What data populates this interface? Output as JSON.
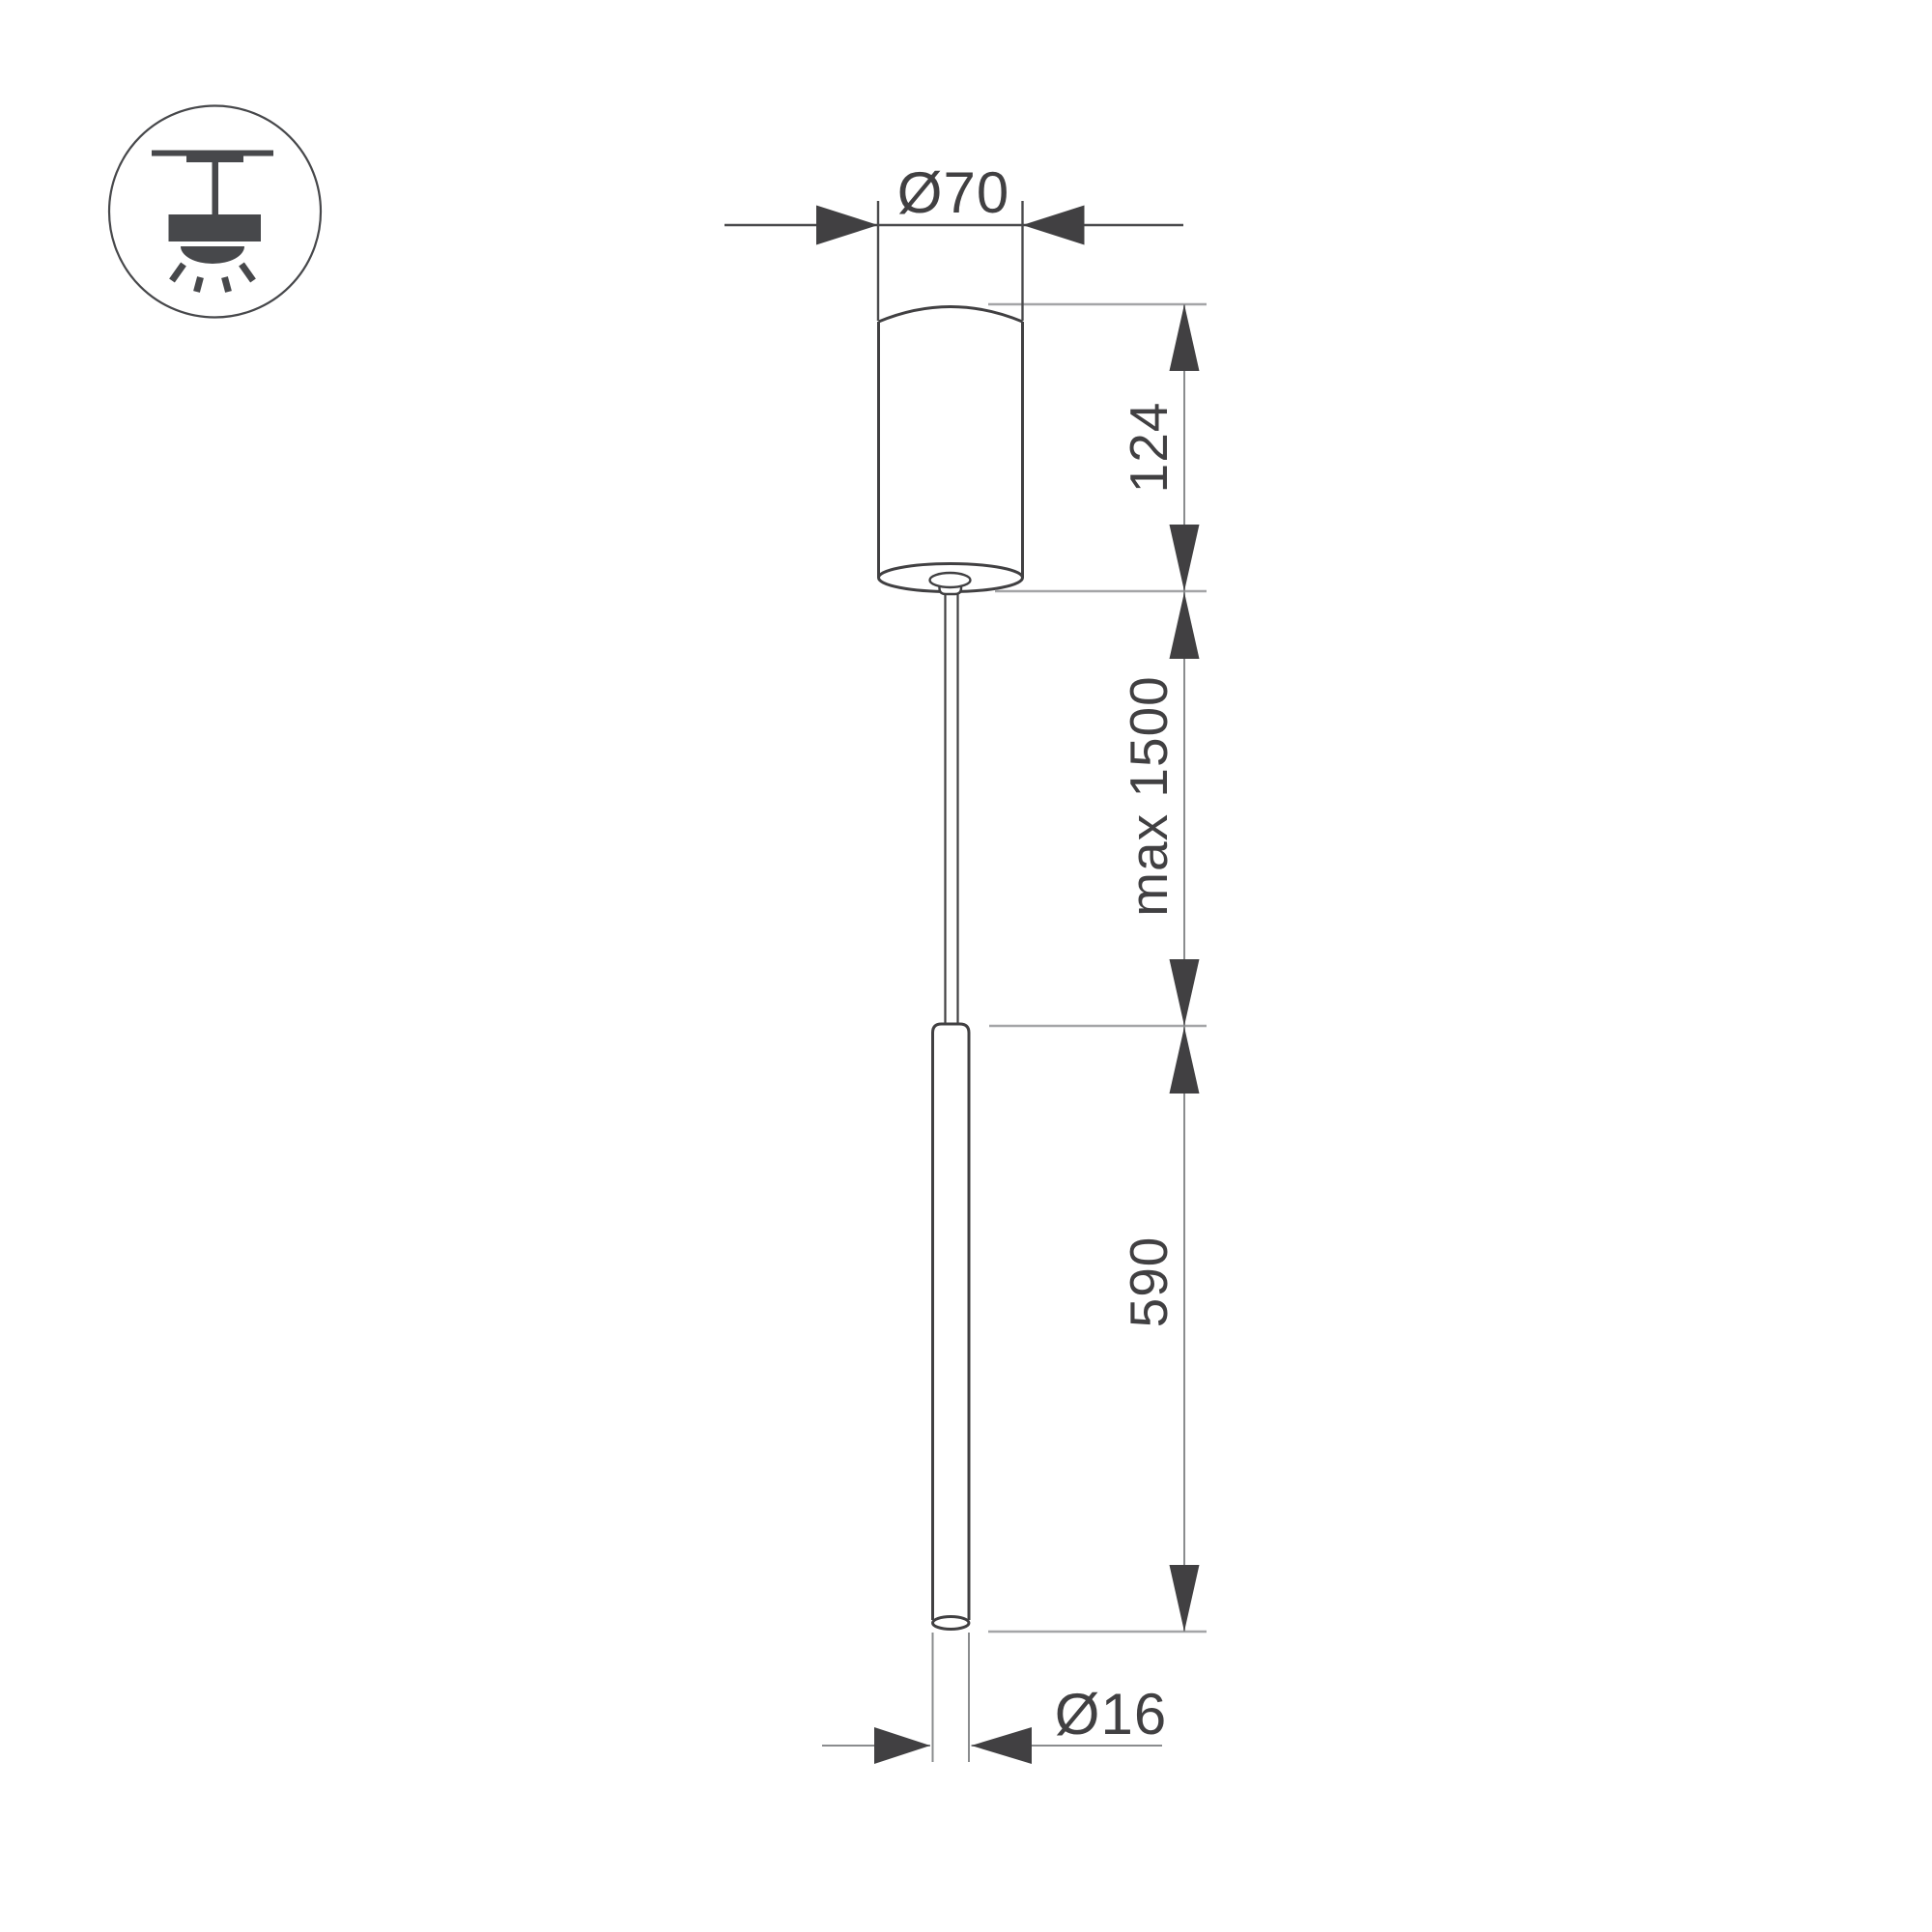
{
  "title": "Pendant luminaire technical dimension drawing",
  "colors": {
    "background": "#ffffff",
    "outline": "#414042",
    "dim_dark": "#4a4a4c",
    "dim_gray": "#8a8c8e",
    "ref_gray": "#a4a5a7",
    "arrow": "#414042",
    "text": "#414042",
    "icon": "#47484b"
  },
  "icon": {
    "name": "ceiling-mounted-pendant-light-icon"
  },
  "dimensions": {
    "canopy_diameter": "Ø70",
    "canopy_height": "124",
    "suspension_max": "max 1500",
    "tube_length": "590",
    "tube_diameter": "Ø16"
  }
}
